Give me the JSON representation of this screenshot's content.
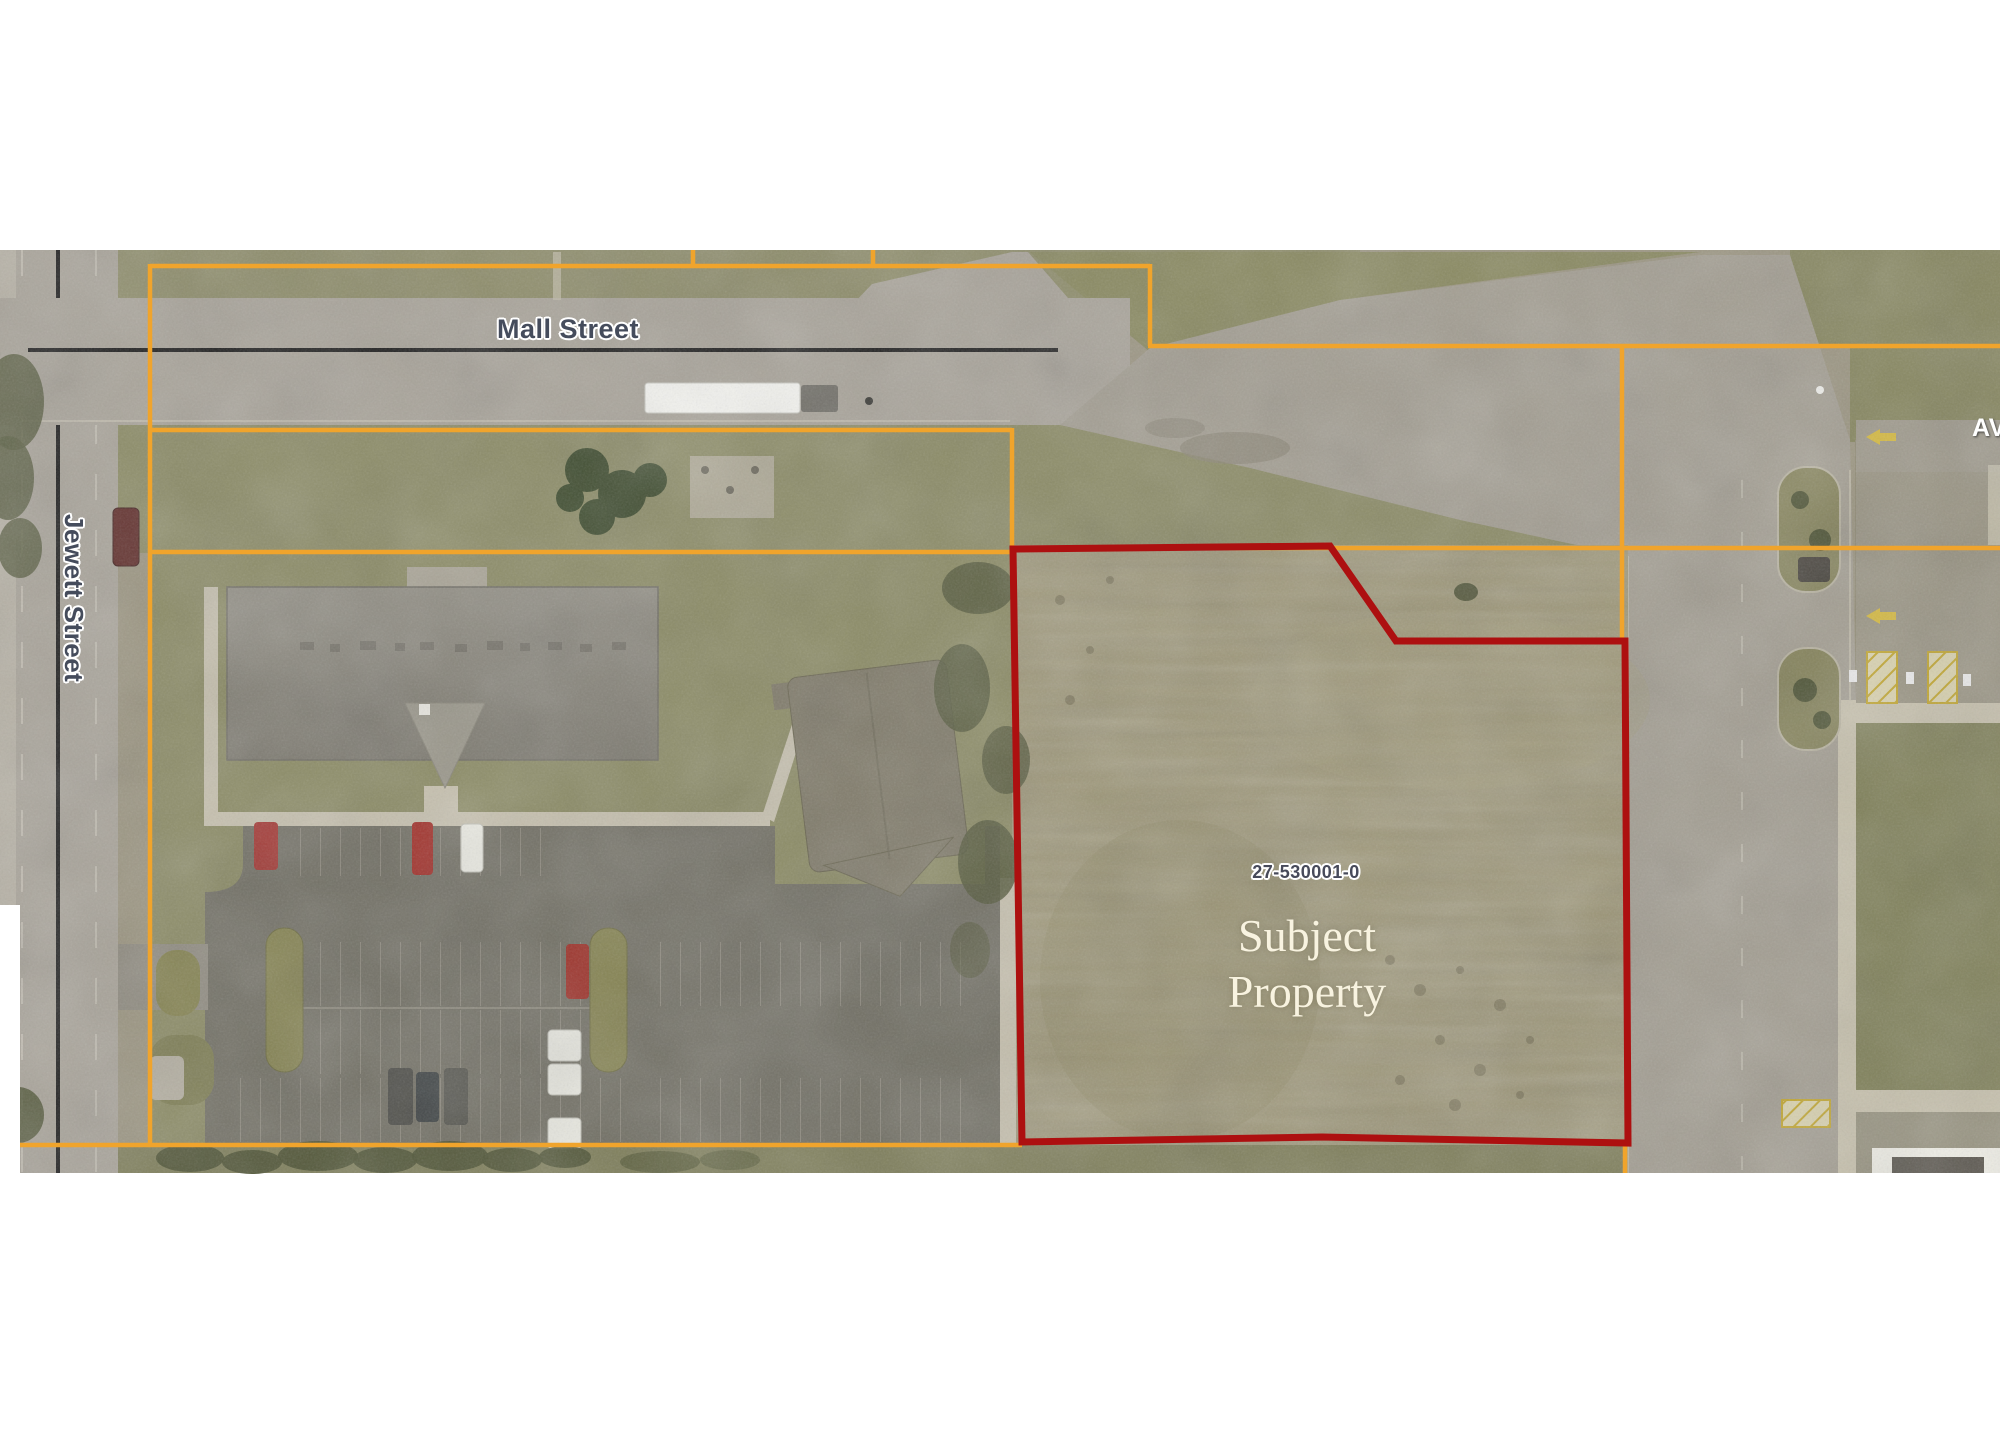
{
  "page": {
    "type": "aerial-parcel-map-exhibit",
    "background": "#ffffff"
  },
  "labels": {
    "mall_street": "Mall Street",
    "jewett_street": "Jewett Street",
    "avenue_fragment": "AV",
    "parcel_id": "27-530001-0",
    "subject_line1": "Subject",
    "subject_line2": "Property"
  },
  "map_colors": {
    "parcel_boundary_line": "#F0A42C",
    "subject_property_boundary": "#AD1010",
    "street_centerline": "#1D1D1D",
    "street_label_color": "#454C5C",
    "parcel_id_color": "#474A5A",
    "subject_label_color": "#F8F3E0"
  }
}
